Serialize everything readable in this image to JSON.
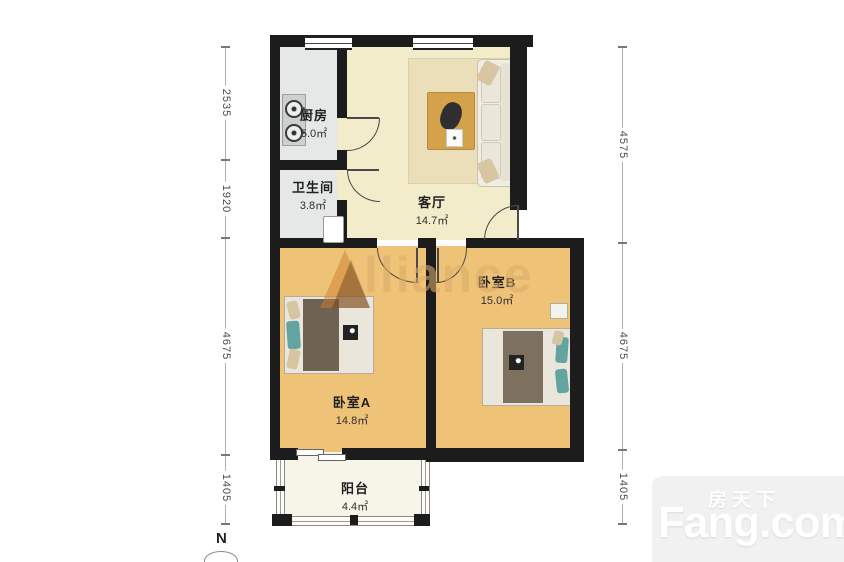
{
  "watermark": {
    "text": "Alliance",
    "text_rest": "lliance"
  },
  "compass": {
    "label": "N"
  },
  "rooms": {
    "kitchen": {
      "name": "厨房",
      "area": "5.0㎡"
    },
    "bathroom": {
      "name": "卫生间",
      "area": "3.8㎡"
    },
    "living": {
      "name": "客厅",
      "area": "14.7㎡"
    },
    "bedroom_a": {
      "name": "卧室A",
      "area": "14.8㎡"
    },
    "bedroom_b": {
      "name": "卧室B",
      "area": "15.0㎡"
    },
    "balcony": {
      "name": "阳台",
      "area": "4.4㎡"
    }
  },
  "dimensions": {
    "left": [
      {
        "value": "2535"
      },
      {
        "value": "1920"
      },
      {
        "value": "4675"
      },
      {
        "value": "1405"
      }
    ],
    "right": [
      {
        "value": "4575"
      },
      {
        "value": "4675"
      },
      {
        "value": "1405"
      }
    ]
  },
  "logo": {
    "cn": "房天下",
    "en": "Fang.com"
  },
  "colors": {
    "wall": "#1c1c1c",
    "tile_floor": "#e6e8e7",
    "living_floor": "#f2ecca",
    "wood_floor": "#efc377",
    "balcony_floor": "#f7f4e8",
    "accent_teal": "#63a3a0",
    "watermark": "#dbac6a",
    "logo_bg": "#f1f1f1"
  }
}
